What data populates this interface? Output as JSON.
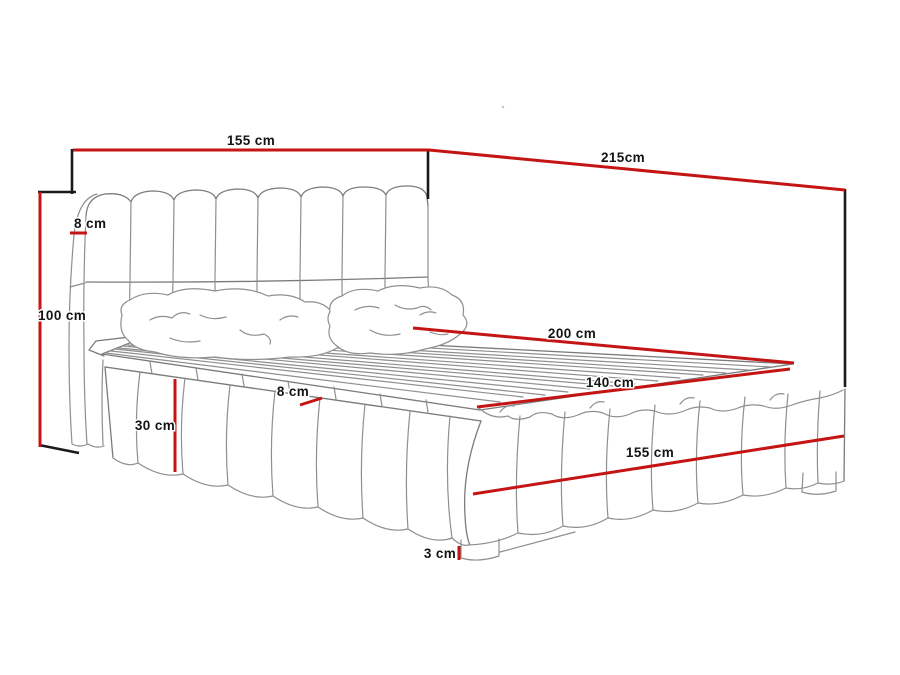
{
  "diagram": {
    "subject": "upholstered-bed-dimension-drawing",
    "units": "cm",
    "labels": {
      "headboard_width": "155 cm",
      "frame_length": "215cm",
      "headboard_height": "100 cm",
      "headboard_thickness": "8 cm",
      "inner_length": "200 cm",
      "inner_width": "140 cm",
      "foot_width": "155 cm",
      "base_side_height": "30 cm",
      "frame_edge_thickness": "8 cm",
      "leg_height": "3 cm"
    },
    "colors": {
      "dimension_line": "#c41414",
      "reference_line": "#1a1a1a",
      "sketch_line": "#8f8f8f",
      "label_text": "#141414",
      "background": "#ffffff"
    }
  }
}
